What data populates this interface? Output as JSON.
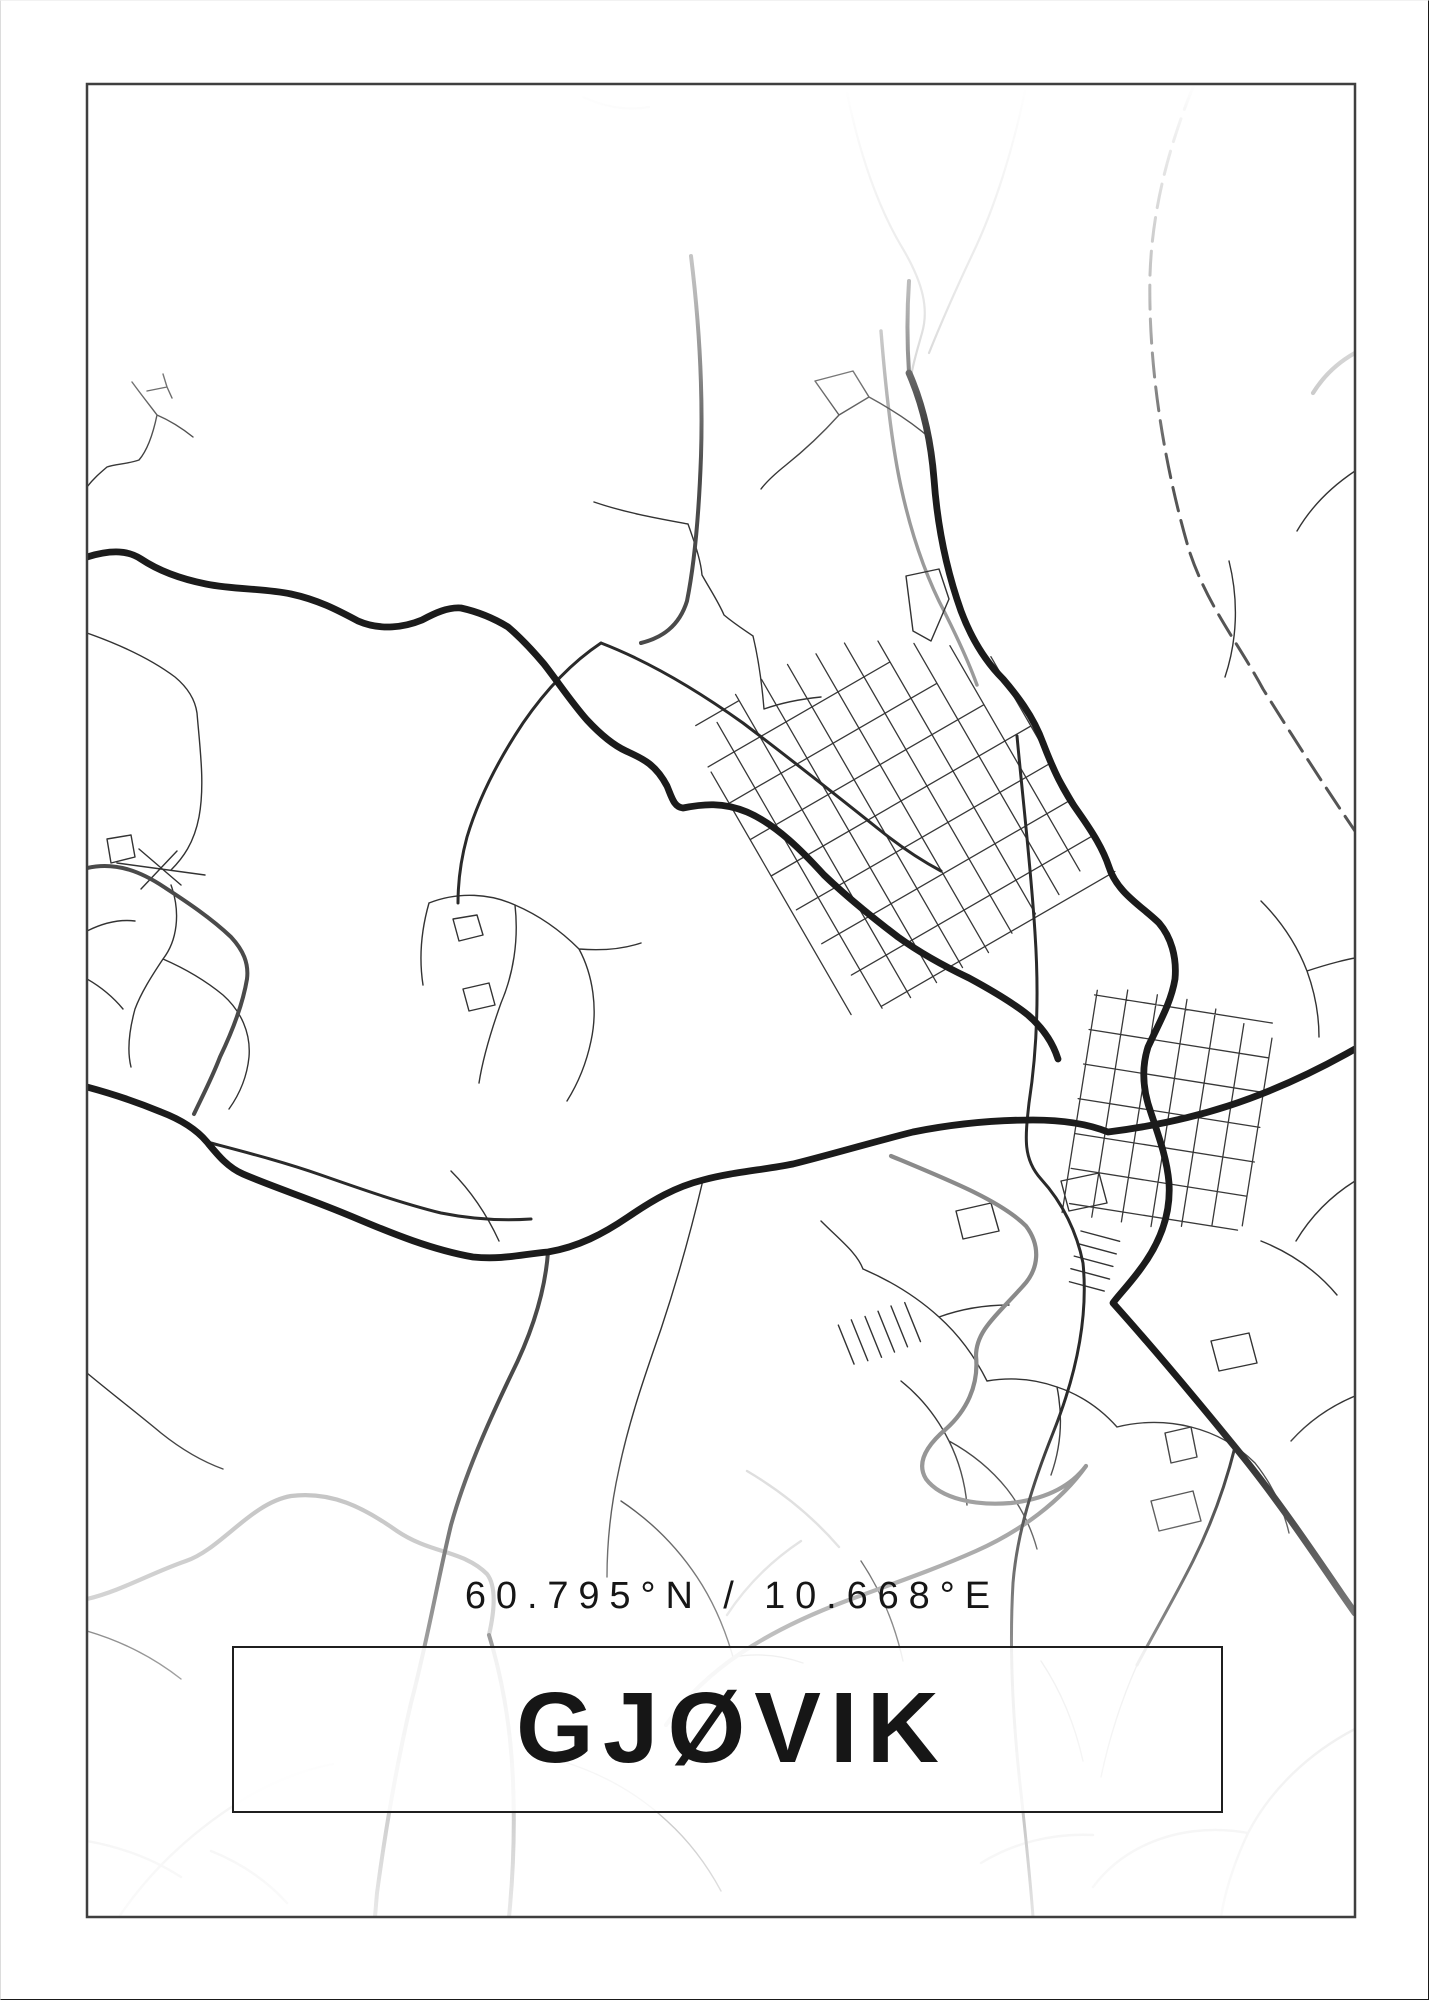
{
  "poster": {
    "coordinates": "60.795°N / 10.668°E",
    "city_name": "GJØVIK"
  },
  "theme": {
    "background": "#ffffff",
    "frame": "#3f3f3f",
    "ink": "#161616",
    "road_dark": "#1b1b1b",
    "road_medium": "#2a2a2a",
    "road_gray": "#8a8a8a",
    "road_light": "#c3c3c3",
    "railway": "#555555",
    "plate_border": "#1f1f1f"
  }
}
